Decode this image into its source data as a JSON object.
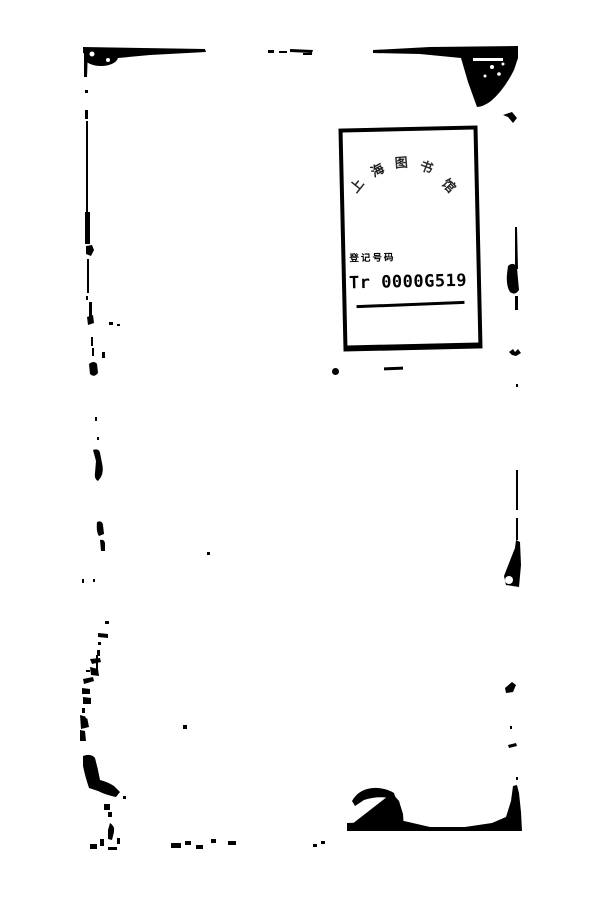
{
  "page": {
    "kind": "scanned book leaf",
    "background_color": "#ffffff",
    "ink_color": "#000000"
  },
  "stamp": {
    "arc_text": "上海图书馆",
    "arc_chars": [
      "上",
      "海",
      "图",
      "书",
      "馆"
    ],
    "label": "登记号码",
    "number": "Tr 0000G519"
  }
}
